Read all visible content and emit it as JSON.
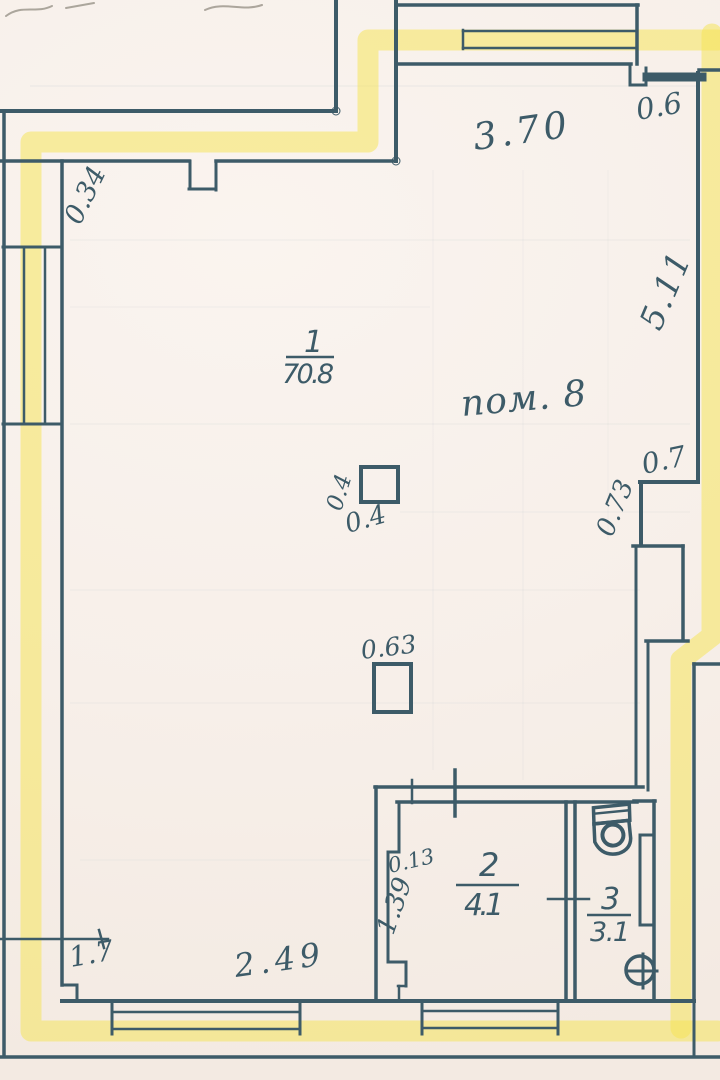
{
  "plan": {
    "rooms": {
      "main": {
        "number": "1",
        "area": "70.8",
        "name": "пом. 8"
      },
      "second": {
        "number": "2",
        "area": "4.1"
      },
      "third": {
        "number": "3",
        "area": "3.1"
      }
    },
    "dimensions": {
      "top_width": "3.70",
      "top_right_gap": "0.6",
      "left_offset": "0.34",
      "right_height": "5.11",
      "niche_width": "0.7",
      "niche_depth": "0.73",
      "column_width": "0.4",
      "column_height": "0.4",
      "column2_width": "0.63",
      "room2_step": "0.13",
      "room2_height": "1.39",
      "bottom_left": "1.7",
      "bottom_width": "2.49"
    },
    "colors": {
      "ink": "#3d5b68",
      "paper": "#f8f1ec",
      "highlighter": "#f5e455"
    }
  }
}
